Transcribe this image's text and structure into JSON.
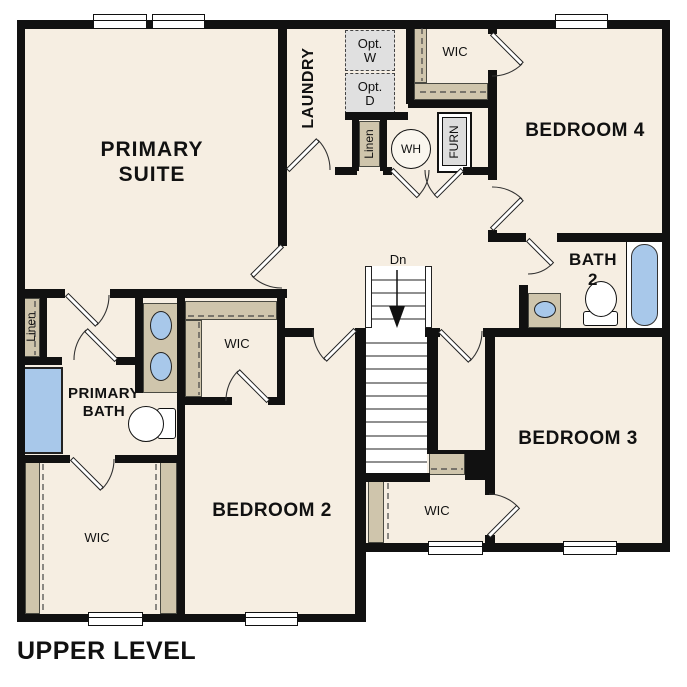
{
  "plan": {
    "title": "UPPER LEVEL",
    "stairs": {
      "label": "Dn"
    },
    "rooms": {
      "primary_suite": {
        "line1": "PRIMARY",
        "line2": "SUITE"
      },
      "laundry": {
        "label": "LAUNDRY"
      },
      "wic_top_center": {
        "label": "WIC"
      },
      "bedroom4": {
        "label": "BEDROOM 4"
      },
      "bath2": {
        "line1": "BATH",
        "line2": "2"
      },
      "bedroom3": {
        "label": "BEDROOM 3"
      },
      "bedroom2": {
        "label": "BEDROOM 2"
      },
      "primary_bath": {
        "line1": "PRIMARY",
        "line2": "BATH"
      },
      "wic_primary_small": {
        "label": "WIC"
      },
      "wic_bottom_left": {
        "label": "WIC"
      },
      "wic_bottom_center": {
        "label": "WIC"
      },
      "linen_hall": {
        "label": "Linen"
      },
      "linen_laundry": {
        "label": "Linen"
      }
    },
    "fixtures": {
      "optional_washer": {
        "line1": "Opt.",
        "line2": "W"
      },
      "optional_dryer": {
        "line1": "Opt.",
        "line2": "D"
      },
      "water_heater": {
        "label": "WH"
      },
      "furnace": {
        "label": "FURN"
      }
    },
    "colors": {
      "floor": "#f6eee2",
      "wall": "#111111",
      "casework_tan": "#cfc5ac",
      "fixture_blue": "#a8c8ea",
      "optional_gray": "#e0e0e0"
    }
  }
}
